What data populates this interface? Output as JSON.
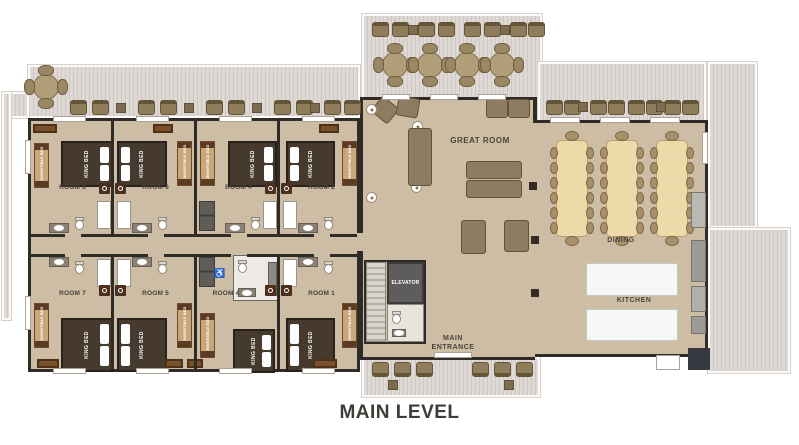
{
  "title": "MAIN LEVEL",
  "labels": {
    "great_room": "GREAT ROOM",
    "dining": "DINING",
    "kitchen": "KITCHEN",
    "elevator": "ELEVATOR",
    "main_entrance": "MAIN ENTRANCE"
  },
  "rooms": {
    "top": [
      {
        "label": "ROOM 8",
        "bed": "KING BED",
        "convertible": "CONVERTIBLE BED"
      },
      {
        "label": "ROOM 6",
        "bed": "KING BED",
        "convertible": "CONVERTIBLE BED"
      },
      {
        "label": "ROOM 4",
        "bed": "KING BED",
        "convertible": "CONVERTIBLE BED"
      },
      {
        "label": "ROOM 2",
        "bed": "KING BED",
        "convertible": "CONVERTIBLE BED"
      }
    ],
    "bottom": [
      {
        "label": "ROOM 7",
        "bed": "KING BED",
        "convertible": "CONVERTIBLE BED"
      },
      {
        "label": "ROOM 5",
        "bed": "KING BED",
        "convertible": "CONVERTIBLE BED"
      },
      {
        "label": "ROOM 4",
        "bed": "KING BED",
        "convertible": "CONVERTIBLE BED",
        "accessible": true
      },
      {
        "label": "ROOM 1",
        "bed": "KING BED",
        "convertible": "CONVERTIBLE BED"
      }
    ]
  },
  "icons": {
    "accessible": "♿"
  },
  "colors": {
    "floor": "#cdbda5",
    "wall": "#2f2b26",
    "deck": "#ded9d4",
    "bed": "#463a2f",
    "convertible_bed": "#c9a77a",
    "dining_table": "#eed9a9",
    "title_text": "#3f3c38",
    "accessible_blue": "#2e6fb5"
  }
}
